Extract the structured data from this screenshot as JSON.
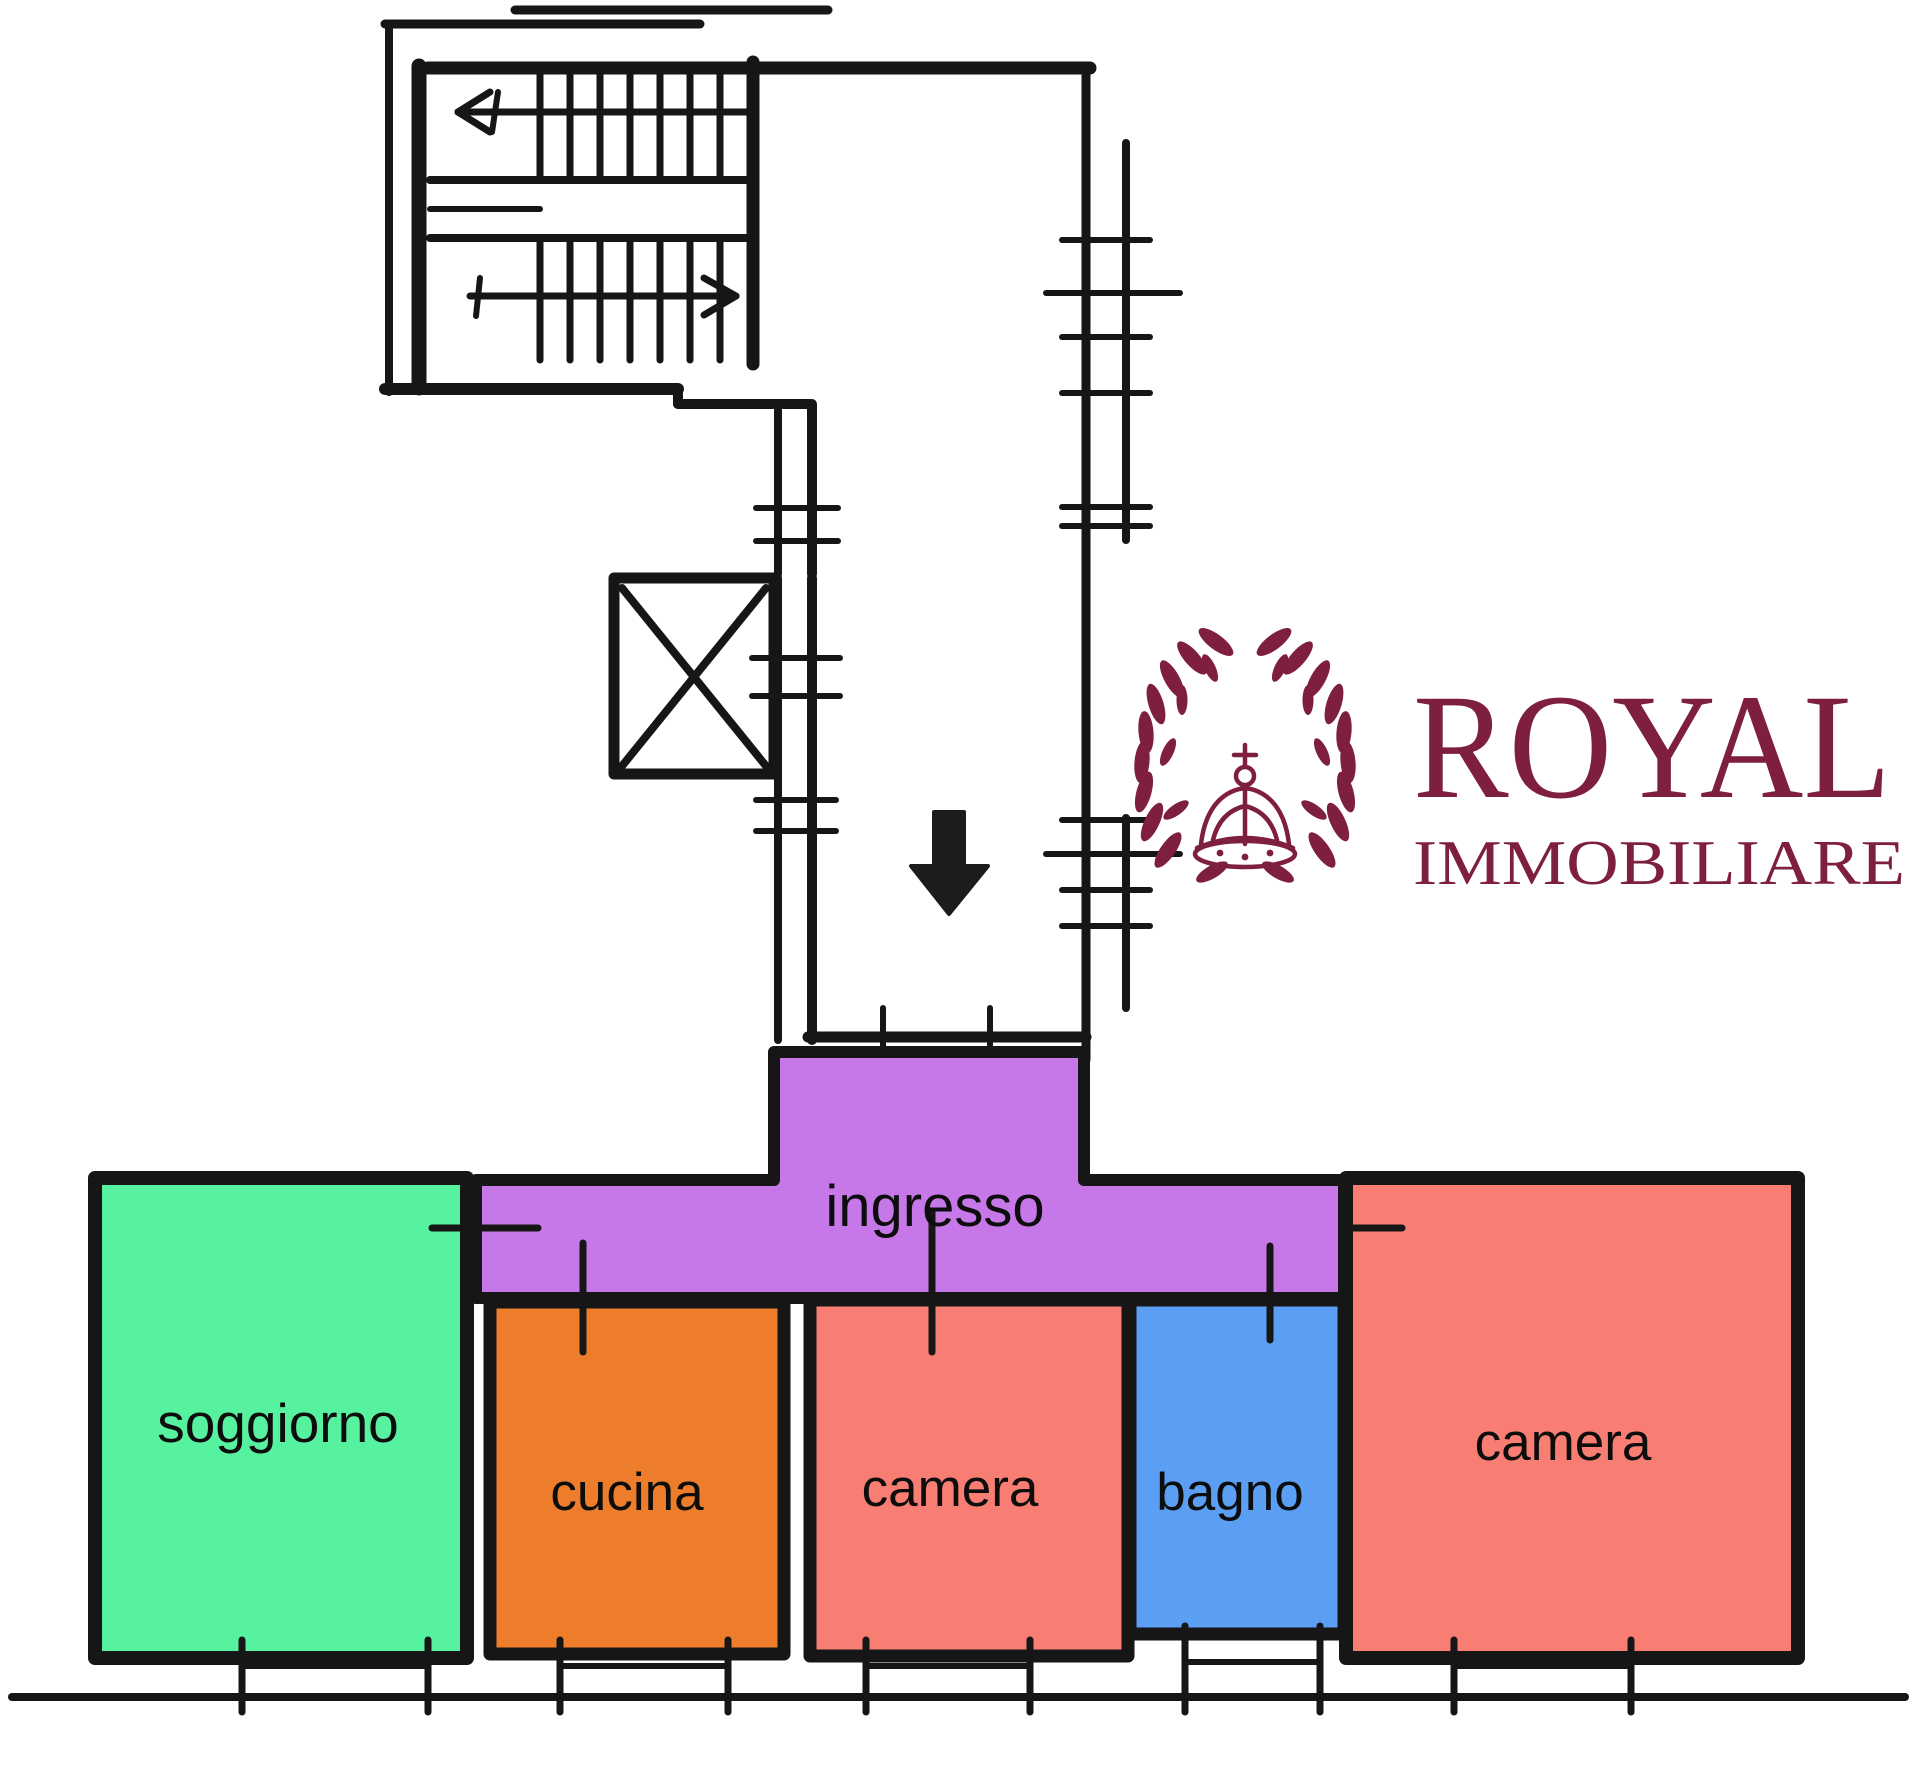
{
  "page": {
    "background": "#ffffff",
    "ink": "#161616",
    "label_color": "#0d0d0d"
  },
  "logo": {
    "name": "ROYAL",
    "subtitle": "IMMOBILIARE",
    "color": "#7e1e41",
    "wreath_icon": "laurel-wreath",
    "crown_icon": "royal-crown"
  },
  "rooms": {
    "ingresso": {
      "label": "ingresso",
      "color": "#c778e8"
    },
    "soggiorno": {
      "label": "soggiorno",
      "color": "#57f2a0"
    },
    "cucina": {
      "label": "cucina",
      "color": "#ed7d2b"
    },
    "camera_mid": {
      "label": "camera",
      "color": "#f87d72"
    },
    "bagno": {
      "label": "bagno",
      "color": "#5b9ff5"
    },
    "camera_right": {
      "label": "camera",
      "color": "#f87d72"
    }
  }
}
